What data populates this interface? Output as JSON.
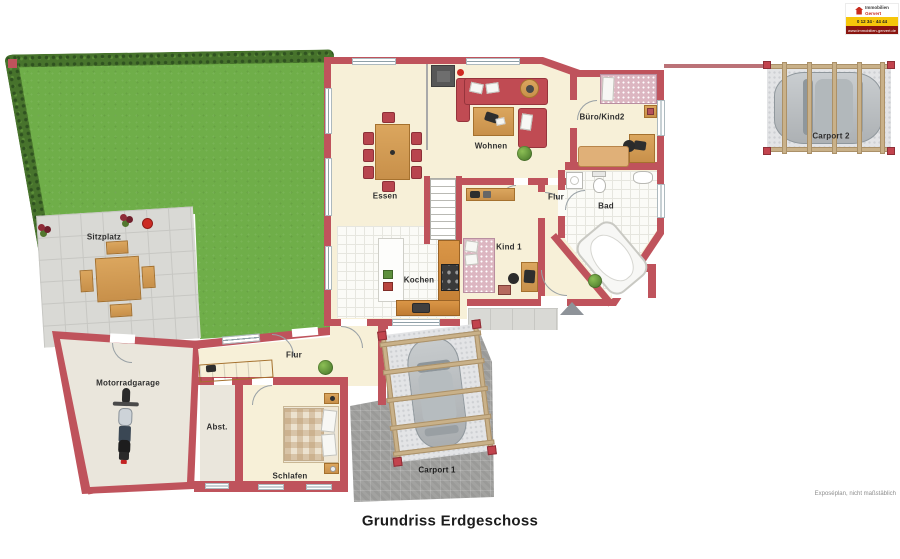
{
  "plan": {
    "title": "Grundriss Erdgeschoss",
    "disclaimer": "Exposéplan, nicht maßstäblich"
  },
  "branding": {
    "name_line1": "Immobilien",
    "name_line2": "Gervert",
    "phone": "0 12 34 · 44 44",
    "website": "www.immobilien-gervert.de"
  },
  "rooms": {
    "essen": "Essen",
    "wohnen": "Wohnen",
    "buero_kind2": "Büro/Kind2",
    "flur_upper": "Flur",
    "bad": "Bad",
    "kind1": "Kind 1",
    "kochen": "Kochen",
    "sitzplatz": "Sitzplatz",
    "motorradgarage": "Motorradgarage",
    "abstellraum": "Abst.",
    "flur_lower": "Flur",
    "schlafen": "Schlafen",
    "carport1": "Carport 1",
    "carport2": "Carport 2"
  },
  "colors": {
    "wall_red": "#bf535c",
    "floor_cream": "#f7f0d8",
    "garden_green": "#6fae49",
    "hedge_green": "#47732c",
    "terrace_gray": "#d9d9d5",
    "driveway_gray": "#a2a2a0",
    "wood_tan": "#d9a35c",
    "sofa_red": "#c04b53",
    "brand_yellow": "#f6c60a",
    "brand_dark_red": "#8a1510"
  }
}
